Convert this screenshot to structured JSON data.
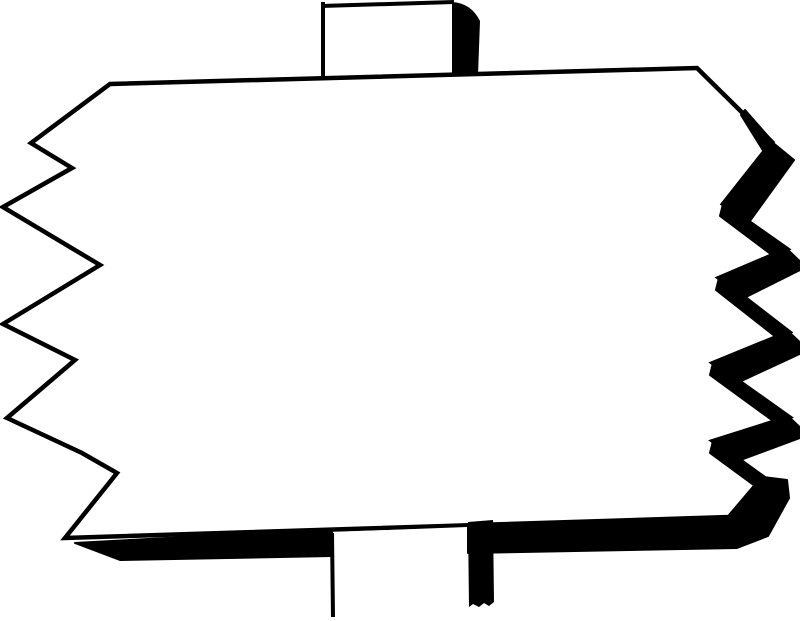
{
  "title": "Blank jagged-edge wooden sign on a post (black and white clipart)",
  "colors": {
    "ink": "#000000",
    "paper": "#ffffff"
  },
  "parts": {
    "board": "blank sign board",
    "top_post": "post stub above board",
    "bottom_post": "post below board",
    "left_edge": "jagged torn left edge",
    "right_edge": "jagged torn right edge with heavy shadow",
    "bottom_edge": "bottom edge shadow band"
  }
}
